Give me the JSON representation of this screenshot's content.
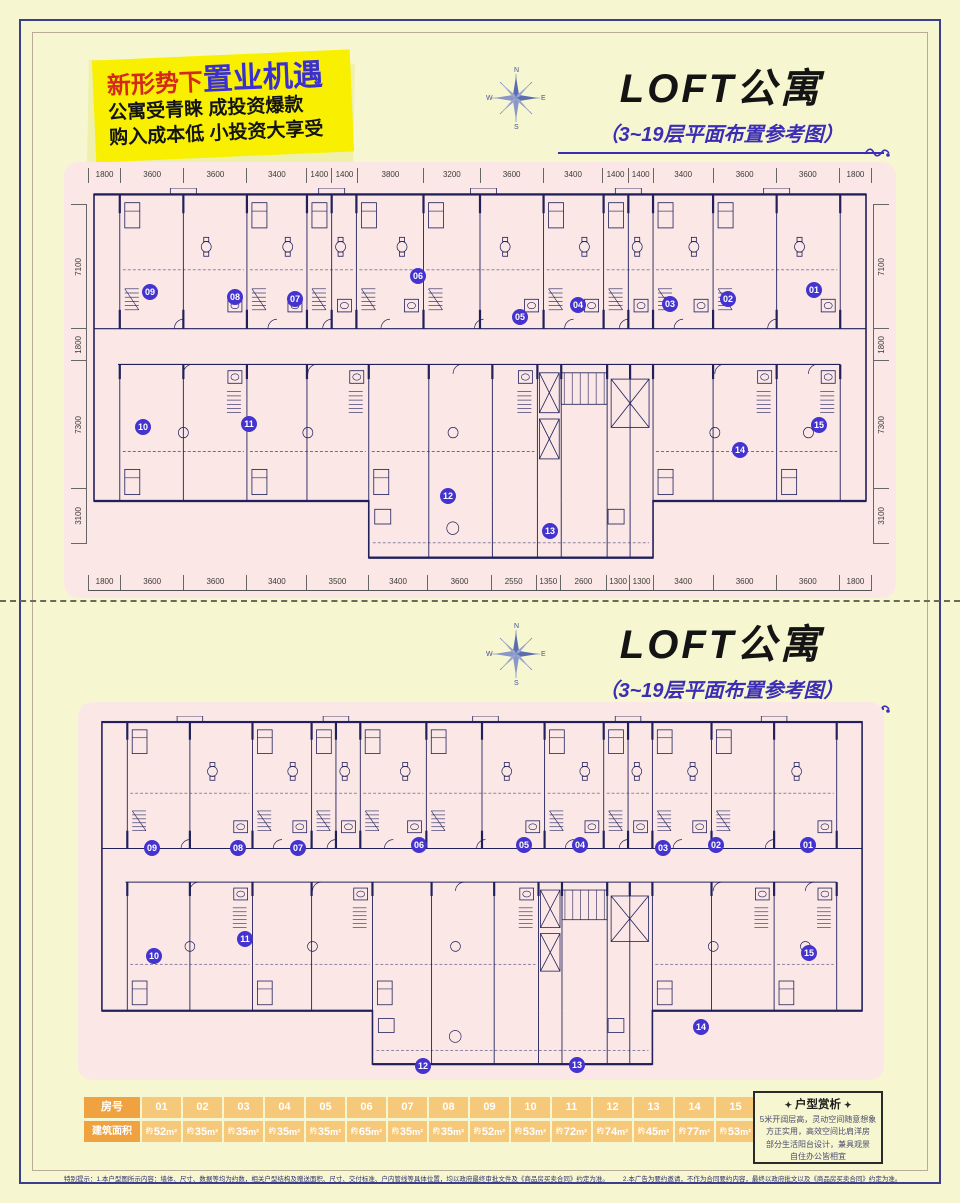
{
  "promo": {
    "line1_red": "新形势下",
    "line1_blue": "置业机遇",
    "line2": "公寓受青睐 成投资爆款",
    "line3": "购入成本低 小投资大享受"
  },
  "compass": {
    "n": "N",
    "e": "E",
    "s": "S",
    "w": "W"
  },
  "section": {
    "title": "LOFT公寓",
    "subtitle": "（3~19层平面布置参考图）"
  },
  "plan1": {
    "dims_top": [
      "1800",
      "3600",
      "3600",
      "3400",
      "1400",
      "1400",
      "3800",
      "3200",
      "3600",
      "3400",
      "1400",
      "1400",
      "3400",
      "3600",
      "3600",
      "1800"
    ],
    "dims_bottom": [
      "1800",
      "3600",
      "3600",
      "3400",
      "3500",
      "3400",
      "3600",
      "2550",
      "1350",
      "2600",
      "1300",
      "1300",
      "3400",
      "3600",
      "3600",
      "1800"
    ],
    "dims_left": [
      "7100",
      "1800",
      "7300",
      "3100"
    ],
    "dims_right": [
      "7100",
      "1800",
      "7300",
      "3100"
    ],
    "units_top": [
      "09",
      "08",
      "07",
      "06",
      "05",
      "04",
      "03",
      "02",
      "01"
    ],
    "units_bottom": [
      "10",
      "11",
      "12",
      "13",
      "14",
      "15"
    ]
  },
  "plan2": {
    "units_top": [
      "09",
      "08",
      "07",
      "06",
      "05",
      "04",
      "03",
      "02",
      "01"
    ],
    "units_bottom": [
      "10",
      "11",
      "12",
      "13",
      "14",
      "15"
    ]
  },
  "table": {
    "row1_label": "房号",
    "row2_label": "建筑面积",
    "rooms": [
      "01",
      "02",
      "03",
      "04",
      "05",
      "06",
      "07",
      "08",
      "09",
      "10",
      "11",
      "12",
      "13",
      "14",
      "15"
    ],
    "area_prefix": "约",
    "areas": [
      "52",
      "35",
      "35",
      "35",
      "35",
      "65",
      "35",
      "35",
      "52",
      "53",
      "72",
      "74",
      "45",
      "77",
      "53"
    ],
    "area_unit": "m²"
  },
  "analysis": {
    "title": "户型赏析",
    "lines": [
      "5米开阔层高，灵动空间随意想象",
      "方正实用，高效空间比肩洋房",
      "部分生活阳台设计，兼具观景",
      "自住办公皆相宜"
    ]
  },
  "disclaimer": {
    "part1": "特别提示：1.本户型图所示内容：墙体、尺寸、数据等均为约数，相关户型结构及赠送面积、尺寸、交付标准、户内管线等具体位置，均以政府最终审批文件及《商品房买卖合同》约定为准。",
    "part2": "2.本广告为要约邀请，不作为合同要约内容，最终以政府批文以及《商品房买卖合同》约定为准。"
  },
  "colors": {
    "accent_blue": "#3b2db5",
    "accent_red": "#d42a1e",
    "promo_yellow": "#f8f000",
    "panel_pink": "#fbe8e6",
    "circle_blue": "#4433cf",
    "table_header_orange": "#efa23f",
    "table_cell_orange": "#f6c87a",
    "plan_line": "#20205c"
  }
}
